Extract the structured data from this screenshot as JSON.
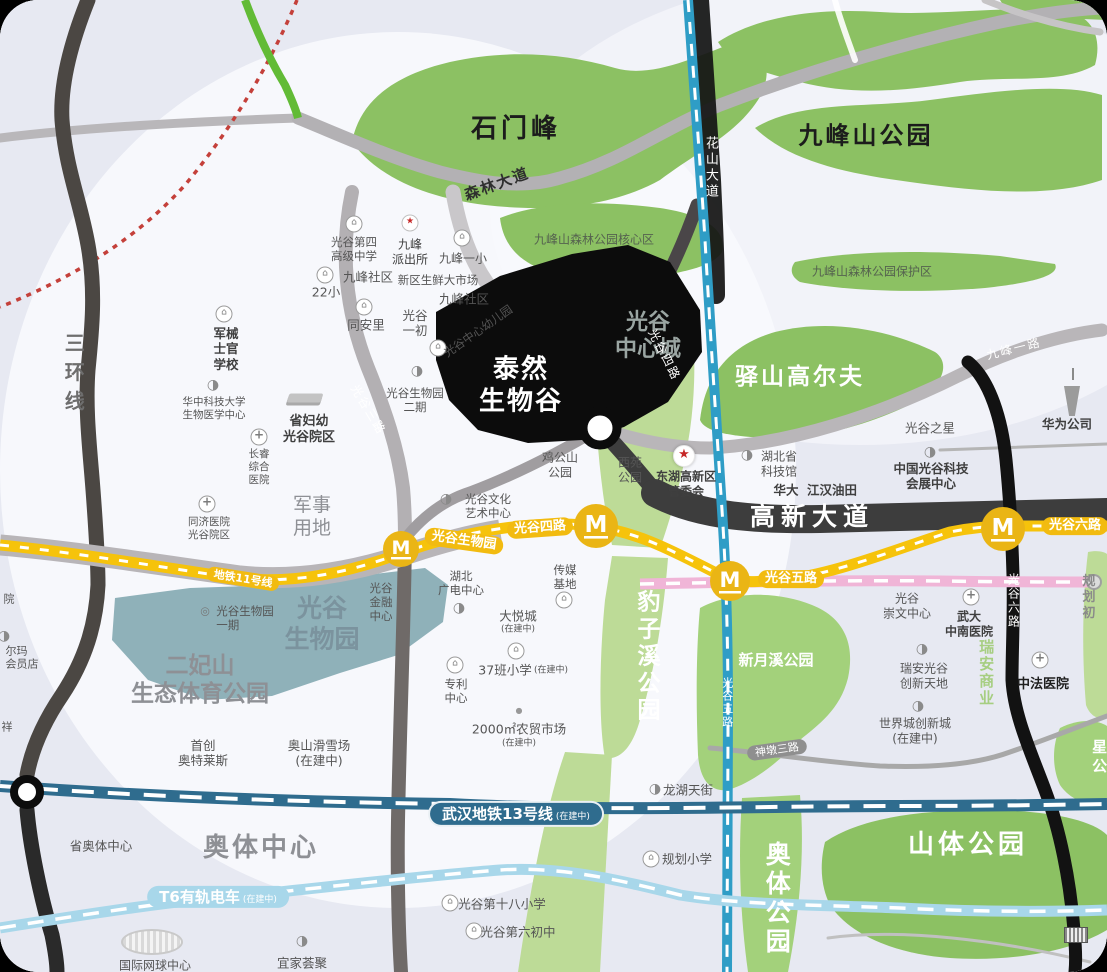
{
  "colors": {
    "bg": "#e7e9f2",
    "park_green": "#8cc163",
    "light_green": "#bddb97",
    "mid_green": "#a3d17b",
    "bio_teal": "#8fb1b9",
    "metro_yellow": "#f6c30b",
    "station_gold": "#eab515",
    "pink_line": "#f0b5d7",
    "blue_road": "#2f9dc6",
    "line13": "#2f6c8e",
    "t6_blue": "#a8d7ea",
    "red_dotted": "#c4403a",
    "dark_road": "#3d3d3d",
    "black_road": "#121212",
    "site_black": "#0c0c0c"
  },
  "icons": {
    "building": "⌂",
    "hospital": "+",
    "star": "★",
    "sector": "◑",
    "ring": "◎",
    "dot": "●"
  },
  "site": {
    "name": "泰然\n生物谷"
  },
  "parks": {
    "shimenfeng": "石门峰",
    "jiufengshan": "九峰山公园",
    "core": "九峰山森林公园核心区",
    "reserve": "九峰山森林公园保护区",
    "golf": "驿山高尔夫",
    "center_city": "光谷\n中心城",
    "baozixi": "豹子溪公园",
    "xinyuexi": "新月溪公园",
    "shanti": "山体公园",
    "aoti_park": "奥体公园",
    "star_partial": "星公",
    "erfeishan": "二妃山\n生态体育公园",
    "bio_park": "光谷\n生物园",
    "aoti_center": "奥体中心",
    "military": "军事\n用地",
    "ruian": "瑞安商业"
  },
  "roads": {
    "sanhuan": "三环线",
    "senlin": "森林大道",
    "huashan": "花山大道",
    "jiufeng1": "九峰一路",
    "gg3": "光谷三路",
    "gg4": "光谷四路",
    "gaoxin": "高新大道",
    "gg6": "光谷六路",
    "gg5": "光谷五路",
    "shendun3": "神墩三路",
    "guihua_partial": "规划初"
  },
  "metro": {
    "m": "M",
    "line11": "地铁11号线",
    "st_biopark": "光谷生物园",
    "st_gg4": "光谷四路",
    "st_gg5": "光谷五路",
    "st_gg6": "光谷六路",
    "line13": "武汉地铁13号线",
    "line13_sub": "(在建中)",
    "t6": "T6有轨电车",
    "t6_sub": "(在建中)"
  },
  "pois": {
    "gg4hs": "光谷第四\n高级中学",
    "jf_police": "九峰\n派出所",
    "jf_primary1": "九峰一小",
    "jf_community1": "九峰社区",
    "s22": "22小",
    "fresh_market": "新区生鲜大市场",
    "jf_community2": "九峰社区",
    "tonganli": "同安里",
    "gg_first_junior": "光谷\n一初",
    "kindergarten": "光谷中心幼儿园",
    "military_school": "军械\n士官\n学校",
    "hust_biomed": "华中科技大学\n生物医学中心",
    "maternal": "省妇幼\n光谷院区",
    "changrui": "长睿\n综合\n医院",
    "tongji": "同济医院\n光谷院区",
    "biopark2": "光谷生物园\n二期",
    "art_center": "光谷文化\n艺术中心",
    "jigongshan": "鸡公山\n公园",
    "xiyuan": "西苑\n公园",
    "admin": "东湖高新区\n管委会",
    "sci_museum": "湖北省\n科技馆",
    "huada": "华大",
    "jianghan": "江汉油田",
    "gg_star": "光谷之星",
    "expo": "中国光谷科技\n会展中心",
    "huawei": "华为公司",
    "finance": "光谷\n金融\n中心",
    "media_center": "湖北\n广电中心",
    "media_base": "传媒\n基地",
    "joycity": "大悦城",
    "joycity_sub": "(在建中)",
    "school37": "37班小学",
    "school37_sub": "(在建中)",
    "patent": "专利\n中心",
    "market2000": "2000㎡农贸市场",
    "market2000_sub": "(在建中)",
    "biopark1": "光谷生物园\n一期",
    "outlets": "首创\n奥特莱斯",
    "ski": "奥山滑雪场\n(在建中)",
    "prov_aoti": "省奥体中心",
    "tennis": "国际网球中心",
    "ikea": "宜家荟聚",
    "primary18": "光谷第十八小学",
    "junior6": "光谷第六初中",
    "plan_primary": "规划小学",
    "longhu": "龙湖天街",
    "chongwen": "光谷\n崇文中心",
    "zhongnan": "武大\n中南医院",
    "ruian_land": "瑞安光谷\n创新天地",
    "worldcity": "世界城创新城\n(在建中)",
    "sino_french": "中法医院",
    "edge_yuan": "院",
    "edge_erma": "尔玛\n会员店",
    "edge_xiang": "祥"
  }
}
